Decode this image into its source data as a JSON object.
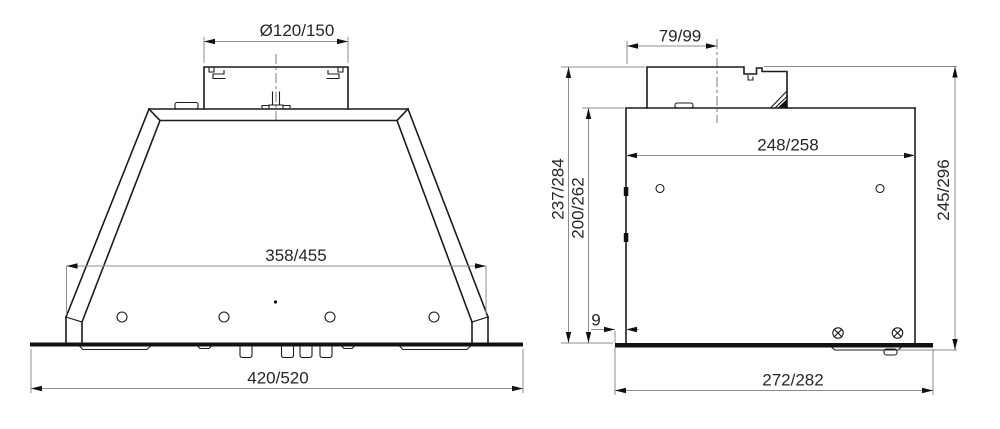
{
  "drawing": {
    "title": "Built-in cooker hood dimensional drawing",
    "background_color": "#ffffff",
    "line_color": "#1c1c1c",
    "dimension_line_color": "#8c8c8c",
    "text_color": "#262626",
    "front_view": {
      "dims": {
        "duct_diameter": "Ø120/150",
        "body_width": "358/455",
        "overall_width": "420/520"
      }
    },
    "side_view": {
      "dims": {
        "duct_width": "79/99",
        "inner_depth": "248/258",
        "height_to_duct_top": "237/284",
        "body_height": "200/262",
        "overall_height": "245/296",
        "edge_offset": "9",
        "plate_depth": "272/282"
      }
    }
  }
}
